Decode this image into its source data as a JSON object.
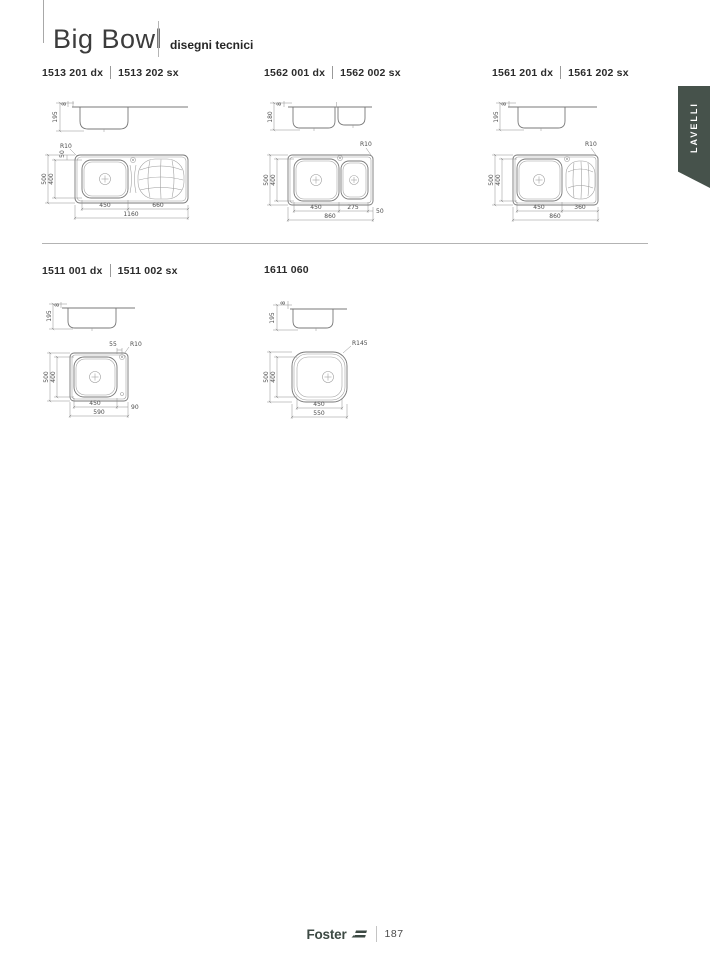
{
  "header": {
    "title": "Big Bowl",
    "subtitle": "disegni tecnici"
  },
  "side_tab": {
    "label": "LAVELLI",
    "color": "#46524b"
  },
  "footer": {
    "brand": "Foster",
    "page_number": "187"
  },
  "drawings": [
    {
      "models": [
        "1513 201 dx",
        "1513 202 sx"
      ],
      "side": {
        "depth": "195",
        "rim": "8"
      },
      "plan": {
        "radius": "R10",
        "edge_top": "50",
        "outer_h": "500",
        "inner_h": "400",
        "dim_a": "450",
        "dim_b": "660",
        "total": "1160"
      }
    },
    {
      "models": [
        "1562 001 dx",
        "1562 002 sx"
      ],
      "side": {
        "depth": "180",
        "rim": "8"
      },
      "plan": {
        "radius": "R10",
        "outer_h": "500",
        "inner_h": "400",
        "dim_a": "450",
        "dim_b": "275",
        "dim_c": "50",
        "total": "860"
      }
    },
    {
      "models": [
        "1561 201 dx",
        "1561 202 sx"
      ],
      "side": {
        "depth": "195",
        "rim": "8"
      },
      "plan": {
        "radius": "R10",
        "outer_h": "500",
        "inner_h": "400",
        "dim_a": "450",
        "dim_b": "360",
        "total": "860"
      }
    },
    {
      "models": [
        "1511 001 dx",
        "1511 002 sx"
      ],
      "side": {
        "depth": "195",
        "rim": "8"
      },
      "plan": {
        "radius": "R10",
        "edge_top": "55",
        "outer_h": "500",
        "inner_h": "400",
        "dim_a": "450",
        "dim_b": "90",
        "total": "590"
      }
    },
    {
      "models": [
        "1611 060"
      ],
      "side": {
        "depth": "195",
        "rim": "8"
      },
      "plan": {
        "radius": "R145",
        "outer_h": "500",
        "inner_h": "400",
        "dim_a": "450",
        "total": "550"
      }
    }
  ]
}
